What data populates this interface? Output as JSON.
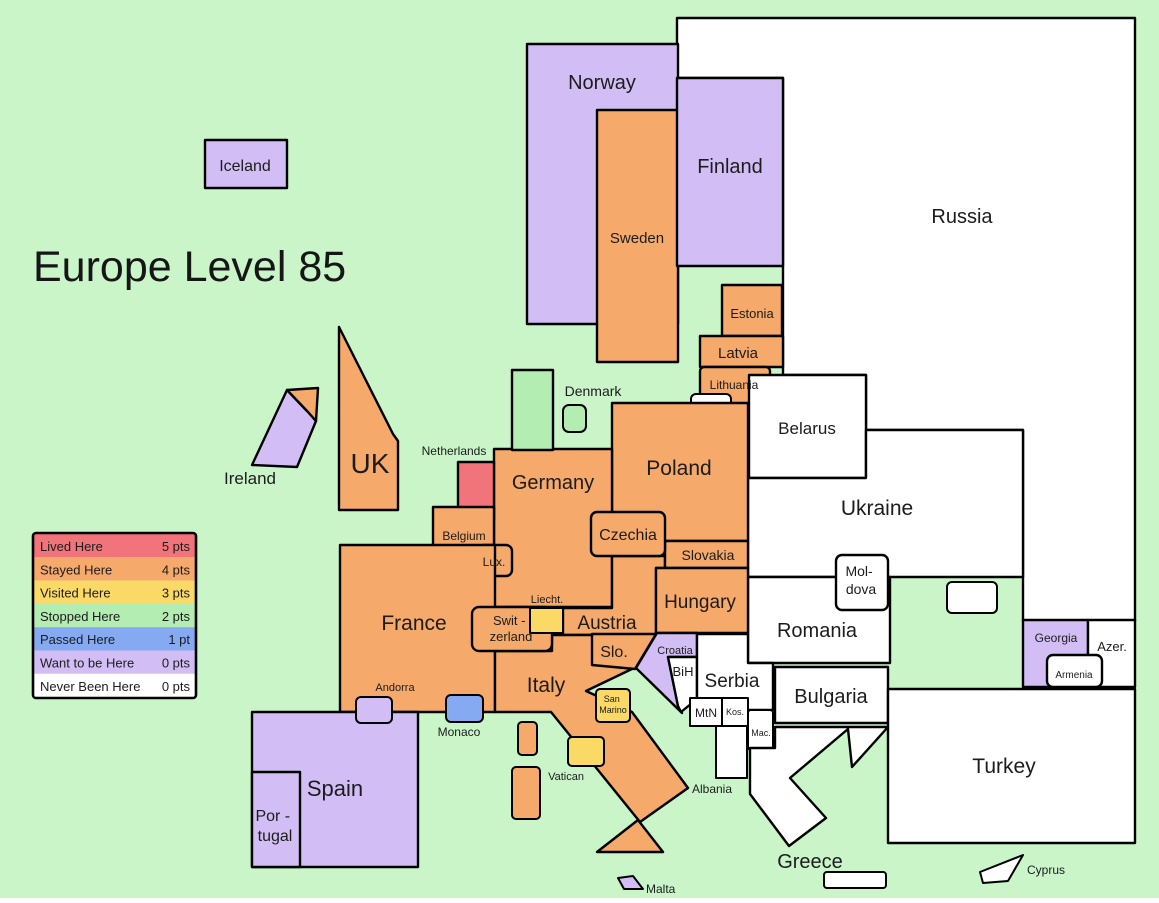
{
  "title": "Europe Level 85",
  "palette": {
    "lived": "#F2747B",
    "stayed": "#F5A96B",
    "visited": "#FAD967",
    "stopped": "#B3EDB1",
    "passed": "#85AAF2",
    "want": "#D2BEF5",
    "never": "#FFFFFF",
    "background": "#C9F5C9",
    "border": "#000000"
  },
  "legend": {
    "items": [
      {
        "label": "Lived Here",
        "points": "5 pts",
        "color": "#F2747B"
      },
      {
        "label": "Stayed Here",
        "points": "4 pts",
        "color": "#F5A96B"
      },
      {
        "label": "Visited Here",
        "points": "3 pts",
        "color": "#FAD967"
      },
      {
        "label": "Stopped Here",
        "points": "2 pts",
        "color": "#B3EDB1"
      },
      {
        "label": "Passed Here",
        "points": "1 pt",
        "color": "#85AAF2"
      },
      {
        "label": "Want to be Here",
        "points": "0 pts",
        "color": "#D2BEF5"
      },
      {
        "label": "Never Been Here",
        "points": "0 pts",
        "color": "#FFFFFF"
      }
    ]
  },
  "countries": {
    "iceland": {
      "label": "Iceland"
    },
    "norway": {
      "label": "Norway"
    },
    "sweden": {
      "label": "Sweden"
    },
    "finland": {
      "label": "Finland"
    },
    "russia": {
      "label": "Russia"
    },
    "estonia": {
      "label": "Estonia"
    },
    "latvia": {
      "label": "Latvia"
    },
    "lithuania": {
      "label": "Lithuania"
    },
    "belarus": {
      "label": "Belarus"
    },
    "denmark": {
      "label": "Denmark"
    },
    "uk": {
      "label": "UK"
    },
    "ireland": {
      "label": "Ireland"
    },
    "netherlands": {
      "label": "Netherlands"
    },
    "germany": {
      "label": "Germany"
    },
    "poland": {
      "label": "Poland"
    },
    "czechia": {
      "label": "Czechia"
    },
    "belgium": {
      "label": "Belgium"
    },
    "luxembourg": {
      "label": "Lux."
    },
    "france": {
      "label": "France"
    },
    "switzerland": {
      "line1": "Swit -",
      "line2": "zerland"
    },
    "liechtenstein": {
      "label": "Liecht."
    },
    "austria": {
      "label": "Austria"
    },
    "slovakia": {
      "label": "Slovakia"
    },
    "hungary": {
      "label": "Hungary"
    },
    "slovenia": {
      "label": "Slo."
    },
    "italy": {
      "label": "Italy"
    },
    "san_marino": {
      "line1": "San",
      "line2": "Marino"
    },
    "vatican": {
      "label": "Vatican"
    },
    "monaco": {
      "label": "Monaco"
    },
    "andorra": {
      "label": "Andorra"
    },
    "spain": {
      "label": "Spain"
    },
    "portugal": {
      "line1": "Por -",
      "line2": "tugal"
    },
    "croatia": {
      "label": "Croatia"
    },
    "bih": {
      "label": "BiH"
    },
    "serbia": {
      "label": "Serbia"
    },
    "montenegro": {
      "label": "MtN"
    },
    "kosovo": {
      "label": "Kos."
    },
    "macedonia": {
      "label": "Mac."
    },
    "albania": {
      "label": "Albania"
    },
    "romania": {
      "label": "Romania"
    },
    "moldova": {
      "line1": "Mol-",
      "line2": "dova"
    },
    "bulgaria": {
      "label": "Bulgaria"
    },
    "ukraine": {
      "label": "Ukraine"
    },
    "greece": {
      "label": "Greece"
    },
    "turkey": {
      "label": "Turkey"
    },
    "cyprus": {
      "label": "Cyprus"
    },
    "malta": {
      "label": "Malta"
    },
    "georgia": {
      "label": "Georgia"
    },
    "azerbaijan": {
      "label": "Azer."
    },
    "armenia": {
      "label": "Armenia"
    }
  }
}
